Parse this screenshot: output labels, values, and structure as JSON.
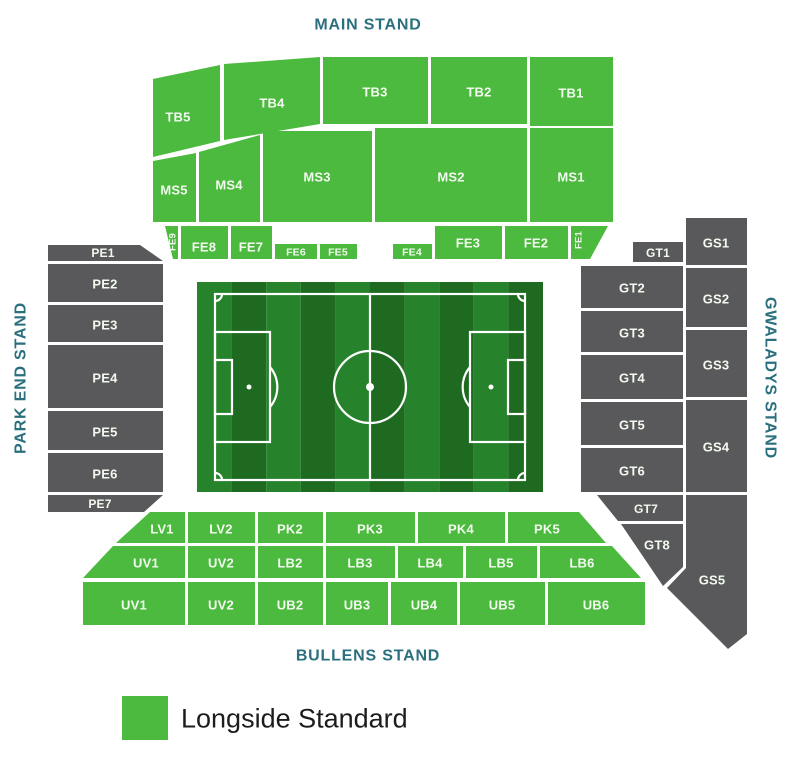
{
  "stands": {
    "main": "MAIN STAND",
    "park_end": "PARK END STAND",
    "gwaladys": "GWALADYS STAND",
    "bullens": "BULLENS STAND"
  },
  "sections": {
    "tb5": "TB5",
    "tb4": "TB4",
    "tb3": "TB3",
    "tb2": "TB2",
    "tb1": "TB1",
    "ms5": "MS5",
    "ms4": "MS4",
    "ms3": "MS3",
    "ms2": "MS2",
    "ms1": "MS1",
    "fe9": "FE9",
    "fe8": "FE8",
    "fe7": "FE7",
    "fe6": "FE6",
    "fe5": "FE5",
    "fe4": "FE4",
    "fe3": "FE3",
    "fe2": "FE2",
    "fe1": "FE1",
    "pe1": "PE1",
    "pe2": "PE2",
    "pe3": "PE3",
    "pe4": "PE4",
    "pe5": "PE5",
    "pe6": "PE6",
    "pe7": "PE7",
    "gt1": "GT1",
    "gt2": "GT2",
    "gt3": "GT3",
    "gt4": "GT4",
    "gt5": "GT5",
    "gt6": "GT6",
    "gt7": "GT7",
    "gt8": "GT8",
    "gs1": "GS1",
    "gs2": "GS2",
    "gs3": "GS3",
    "gs4": "GS4",
    "gs5": "GS5",
    "lv1": "LV1",
    "lv2": "LV2",
    "pk2": "PK2",
    "pk3": "PK3",
    "pk4": "PK4",
    "pk5": "PK5",
    "uv1_middle": "UV1",
    "uv2_middle": "UV2",
    "lb2": "LB2",
    "lb3": "LB3",
    "lb4": "LB4",
    "lb5": "LB5",
    "lb6": "LB6",
    "uv1_lower": "UV1",
    "uv2_lower": "UV2",
    "ub2": "UB2",
    "ub3": "UB3",
    "ub4": "UB4",
    "ub5": "UB5",
    "ub6": "UB6"
  },
  "legend": {
    "swatch_color": "#4cba3e",
    "label": "Longside Standard"
  },
  "colors": {
    "longside_standard": "#4cba3e",
    "unavailable": "#59595b",
    "stand_label": "#2a6f7d",
    "pitch_stripe_light": "#27832b",
    "pitch_stripe_dark": "#1e6a21"
  }
}
